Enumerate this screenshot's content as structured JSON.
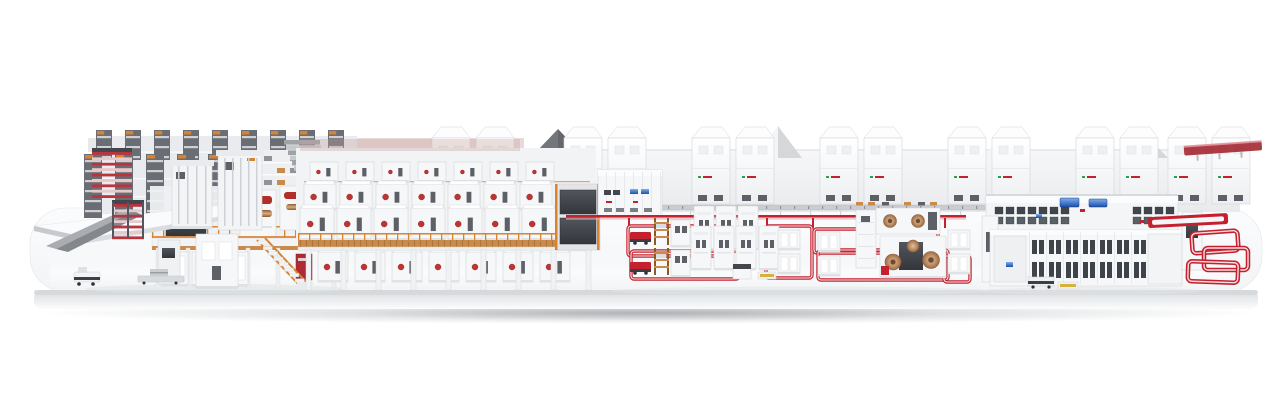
{
  "scene": {
    "subject": "industrial-production-line-3d-render",
    "background": "#ffffff",
    "platform_style": "rounded-white-display-base"
  },
  "colors": {
    "accent_red": "#c4202e",
    "red_dark": "#9e1b27",
    "red_soft": "#e9aeb3",
    "orange": "#d9832f",
    "wood": "#c98a4a",
    "wood_dark": "#8a5a28",
    "copper": "#b5805e",
    "copper_light": "#ddb88f",
    "dark": "#43474d",
    "dark_soft": "#5d6167",
    "machine": "#f6f7f8",
    "machine_stroke": "#d2d5d9",
    "wall": "#f2f3f5",
    "wall_shade": "#e4e6e9",
    "platform_top": "#f8f9fa",
    "platform_lip": "#d5d8db",
    "platform_face": "#eceef0",
    "gable_dark": "#73767b",
    "metal": "#b9bcc0",
    "screen_blue": "#2f66c4",
    "yellow": "#d8b13c",
    "logo_green": "#2e9e4f"
  },
  "structure": {
    "cabinet_xs": [
      432,
      476,
      564,
      608,
      692,
      736,
      820,
      864,
      948,
      992,
      1076,
      1120,
      1168,
      1212
    ],
    "cabinet": {
      "y": 138,
      "w": 38,
      "h": 66
    },
    "gables": [
      {
        "x": 536,
        "w": 44,
        "apex": 129,
        "base": 152,
        "dark": true
      },
      {
        "x": 754,
        "w": 48,
        "apex": 126,
        "base": 158,
        "dark": false
      },
      {
        "x": 982,
        "w": 48,
        "apex": 131,
        "base": 158,
        "dark": false
      },
      {
        "x": 1126,
        "w": 42,
        "apex": 136,
        "base": 158,
        "dark": false
      }
    ],
    "rack_banks": [
      {
        "x": 96,
        "y": 130,
        "count": 9,
        "pitch": 29,
        "tower_w": 16,
        "h": 56
      },
      {
        "x": 84,
        "y": 154,
        "count": 5,
        "pitch": 31,
        "tower_w": 18,
        "h": 64
      }
    ],
    "shelf_texture": {
      "x": 236,
      "y": 150,
      "rows": 5,
      "cols": 8,
      "row_h": 12,
      "col_w": 13
    },
    "red_banks": [
      {
        "x": 92,
        "y": 152,
        "w": 40,
        "h": 46
      },
      {
        "x": 112,
        "y": 204,
        "w": 32,
        "h": 34
      }
    ],
    "roof_slats": {
      "x": 284,
      "y": 140,
      "count": 6
    },
    "mezz": {
      "railing": {
        "x0": 152,
        "x1": 338,
        "y": 226,
        "h": 12
      },
      "columns": [
        156,
        186,
        216,
        246,
        276,
        306,
        332
      ],
      "cabinets": [
        162,
        192,
        222
      ],
      "stairs": {
        "x": 258,
        "y": 241,
        "steps": 8
      }
    },
    "module_rows": [
      {
        "x": 310,
        "y": 162,
        "count": 7,
        "pitch": 36,
        "w": 28,
        "h": 20,
        "small": true
      },
      {
        "x": 304,
        "y": 184,
        "count": 7,
        "pitch": 36,
        "w": 32,
        "h": 26
      },
      {
        "x": 300,
        "y": 208,
        "count": 8,
        "pitch": 37,
        "w": 34,
        "h": 32
      },
      {
        "x": 318,
        "y": 252,
        "count": 7,
        "pitch": 37,
        "w": 30,
        "h": 30
      }
    ],
    "line_railing": {
      "x0": 298,
      "x1": 590,
      "y": 233,
      "h": 9
    },
    "legs": {
      "x": 306,
      "count": 9,
      "pitch": 35,
      "y": 250,
      "h": 40,
      "w": 5
    },
    "conveyor": {
      "x": 620,
      "y": 205,
      "w": 365,
      "cargo": [
        [
          856,
          "wood"
        ],
        [
          868,
          "wood"
        ],
        [
          882,
          "dark"
        ],
        [
          904,
          "wood"
        ],
        [
          918,
          "dark"
        ],
        [
          930,
          "wood"
        ]
      ]
    },
    "red_line": {
      "x": 566,
      "y": 215,
      "w": 400
    },
    "red_drops": [
      628,
      732,
      766,
      812,
      944
    ],
    "red_loops": [
      [
        628,
        226,
        104,
        30
      ],
      [
        631,
        251,
        108,
        28
      ],
      [
        766,
        226,
        46,
        52
      ],
      [
        814,
        229,
        124,
        24
      ],
      [
        818,
        250,
        130,
        30
      ],
      [
        944,
        256,
        26,
        26
      ]
    ],
    "red_spiral": [
      [
        1192,
        232,
        46,
        20,
        -4
      ],
      [
        1204,
        248,
        44,
        22,
        0
      ],
      [
        1188,
        262,
        50,
        20,
        2
      ]
    ],
    "finishing": {
      "grids": [
        {
          "x": 995,
          "y": 207,
          "cols": 7,
          "rows": 2,
          "cw": 8,
          "ch": 7,
          "gx": 3,
          "gy": 3
        },
        {
          "x": 1133,
          "y": 207,
          "cols": 4,
          "rows": 2,
          "cw": 8,
          "ch": 7,
          "gx": 3,
          "gy": 3
        },
        {
          "x": 998,
          "y": 238,
          "cols": 2,
          "rows": 3,
          "cw": 10,
          "ch": 11,
          "gx": 4,
          "gy": 4
        },
        {
          "x": 1152,
          "y": 238,
          "cols": 2,
          "rows": 2,
          "cw": 10,
          "ch": 10,
          "gx": 5,
          "gy": 6
        }
      ],
      "doors": {
        "x0": 1032,
        "x1": 1148,
        "pitch": 17,
        "rows": [
          [
            240,
            14
          ],
          [
            262,
            16
          ]
        ]
      }
    },
    "control_seams": {
      "x0": 606,
      "x1": 660,
      "pitch": 9,
      "y": 172,
      "h": 42
    },
    "gantry_struts": [
      {
        "x0": 178,
        "count": 4,
        "pitch": 9,
        "y": 166,
        "h": 58
      },
      {
        "x0": 224,
        "count": 5,
        "pitch": 8,
        "y": 158,
        "h": 68
      }
    ]
  }
}
